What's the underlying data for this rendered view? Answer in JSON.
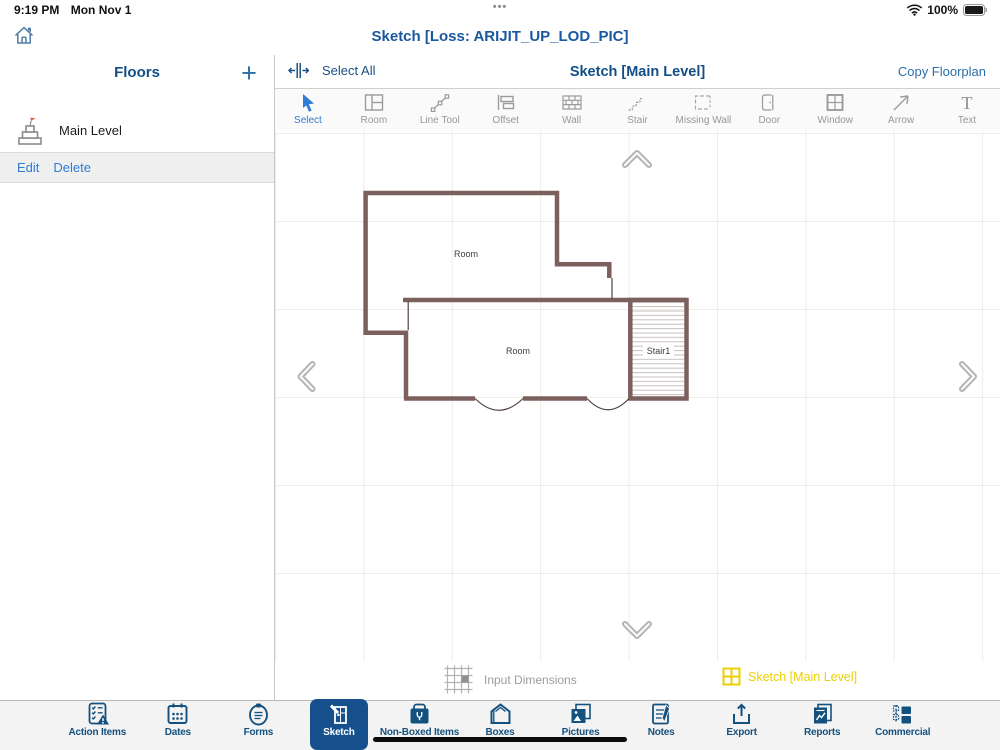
{
  "status_bar": {
    "time": "9:19 PM",
    "date": "Mon Nov 1",
    "ellipsis": "•••",
    "battery_percent": "100%"
  },
  "app_header": {
    "title": "Sketch [Loss: ARIJIT_UP_LOD_PIC]"
  },
  "sidebar": {
    "title": "Floors",
    "add_label": "+",
    "floors": [
      {
        "name": "Main Level"
      }
    ],
    "actions": {
      "edit": "Edit",
      "delete": "Delete"
    }
  },
  "canvas_header": {
    "select_all": "Select All",
    "title": "Sketch [Main Level]",
    "copy_floorplan": "Copy Floorplan"
  },
  "tools": [
    {
      "label": "Select",
      "selected": true
    },
    {
      "label": "Room"
    },
    {
      "label": "Line Tool"
    },
    {
      "label": "Offset"
    },
    {
      "label": "Wall"
    },
    {
      "label": "Stair"
    },
    {
      "label": "Missing Wall"
    },
    {
      "label": "Door"
    },
    {
      "label": "Window"
    },
    {
      "label": "Arrow"
    },
    {
      "label": "Text"
    }
  ],
  "floorplan": {
    "rooms": [
      {
        "label": "Room"
      },
      {
        "label": "Room"
      }
    ],
    "stair": {
      "label": "Stair1"
    }
  },
  "canvas_footer": {
    "input_dimensions": "Input Dimensions",
    "active_sketch": "Sketch [Main Level]"
  },
  "tab_bar": [
    {
      "label": "Action Items"
    },
    {
      "label": "Dates"
    },
    {
      "label": "Forms"
    },
    {
      "label": "Sketch",
      "selected": true
    },
    {
      "label": "Non-Boxed Items"
    },
    {
      "label": "Boxes"
    },
    {
      "label": "Pictures"
    },
    {
      "label": "Notes"
    },
    {
      "label": "Export"
    },
    {
      "label": "Reports"
    },
    {
      "label": "Commercial"
    }
  ],
  "colors": {
    "navy": "#14517e",
    "title_blue": "#1a58a0",
    "link_blue": "#2e7cd6",
    "wall_brown": "#7c605d",
    "highlight_yellow": "#ecd000",
    "selected_tab_bg": "#15508c",
    "grid": "#f1ebe8"
  }
}
